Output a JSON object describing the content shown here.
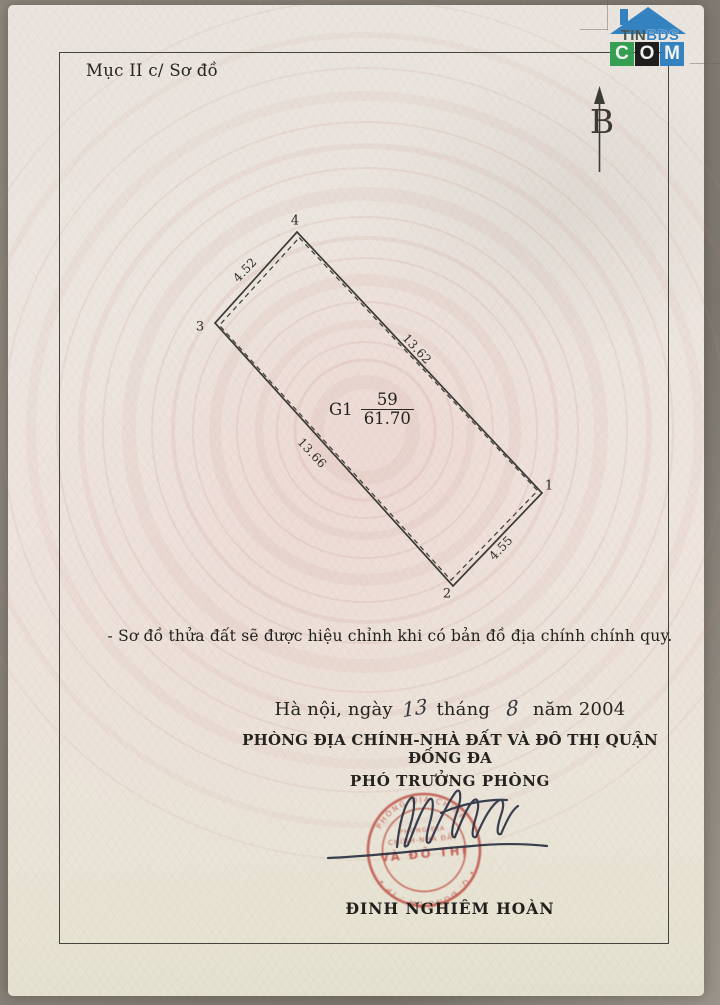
{
  "page": {
    "section_label": "Mục II c/ Sơ đồ",
    "north_label": "B"
  },
  "logo": {
    "top_word_part1": "TIN",
    "top_word_part2": "BDS",
    "bottom_letters": [
      "C",
      "O",
      "M"
    ]
  },
  "plot": {
    "corner_labels": {
      "c1": "1",
      "c2": "2",
      "c3": "3",
      "c4": "4"
    },
    "dimensions": {
      "edge_3_4": "4.52",
      "edge_4_1": "13.62",
      "edge_3_2": "13.66",
      "edge_1_2": "4.55"
    },
    "label": {
      "code": "G1",
      "numerator": "59",
      "denominator": "61.70"
    }
  },
  "note": "- Sơ đồ thửa đất sẽ được hiệu chỉnh khi có bản đồ địa chính chính quy.",
  "signing": {
    "date_prefix": "Hà nội, ngày",
    "date_day": "13",
    "date_thang": "tháng",
    "date_month": "8",
    "date_nam": "năm",
    "date_year": "2004",
    "department": "PHÒNG ĐỊA CHÍNH-NHÀ ĐẤT VÀ ĐÔ THỊ QUẬN ĐỐNG ĐA",
    "signer_title": "PHÓ TRƯỞNG PHÒNG",
    "signer_name": "ĐINH NGHIÊM HOÀN",
    "stamp": {
      "ring_top": "PHÒNG ĐỊA CHÍNH",
      "center_line1": "PHÒNG ĐỊA",
      "center_line2": "CHÍNH-NHÀ ĐẤT",
      "center_line3": "VÀ ĐÔ THỊ",
      "ring_bottom": "• Q. ĐỐNG ĐA . TP •"
    }
  },
  "colors": {
    "stamp_red": "#bf5348",
    "ink_blue": "#2a3142",
    "logo_blue": "#2e7fc0",
    "logo_green": "#2f9d4e",
    "paper": "#ece5df"
  }
}
